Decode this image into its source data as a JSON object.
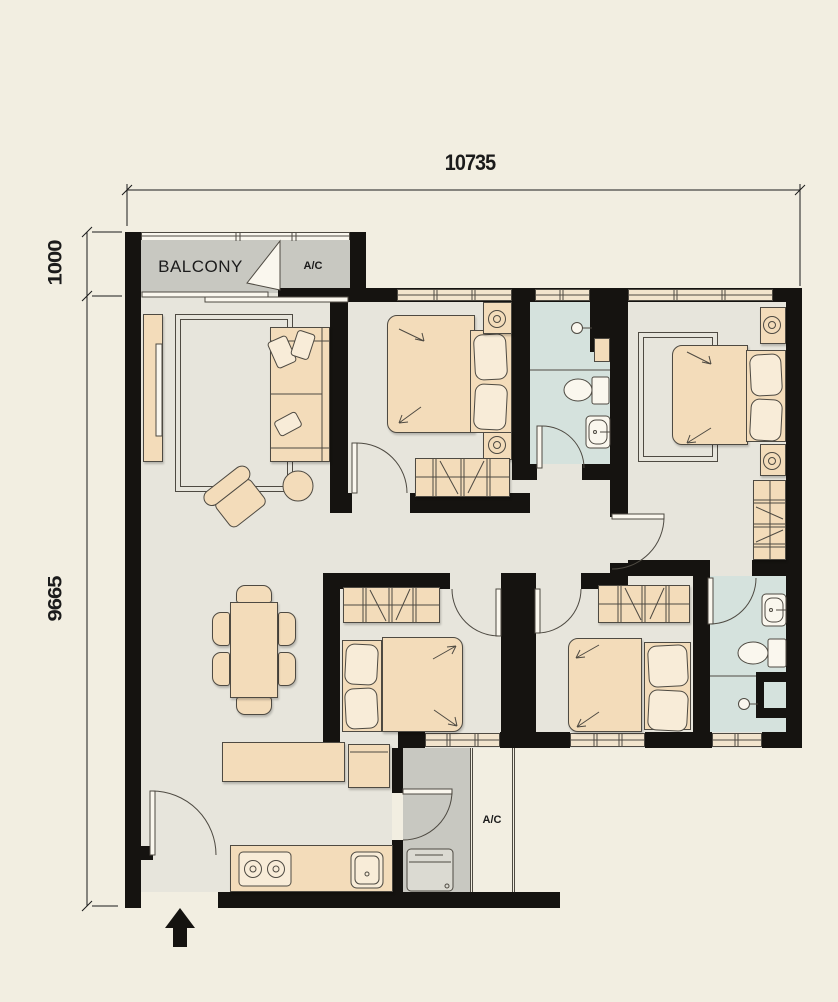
{
  "plan": {
    "dimensions": {
      "top": "10735",
      "left_upper": "1000",
      "left_lower": "9665"
    },
    "labels": {
      "balcony": "BALCONY",
      "balcony_ac": "A/C",
      "service_ac": "A/C"
    }
  },
  "icons": {
    "entrance_arrow": "up-arrow"
  },
  "colors": {
    "background": "#f2eee1",
    "wall": "#151310",
    "floor": "#e7e5dc",
    "bathroom": "#d5e2dd",
    "balcony": "#c8c8c1",
    "furniture": "#f3dcba",
    "furniture_light": "#f8ecd8",
    "outline": "#4e4a42",
    "paper": "#faf7ee",
    "appliance": "#dbdad2",
    "ink": "#1b1b1b"
  }
}
